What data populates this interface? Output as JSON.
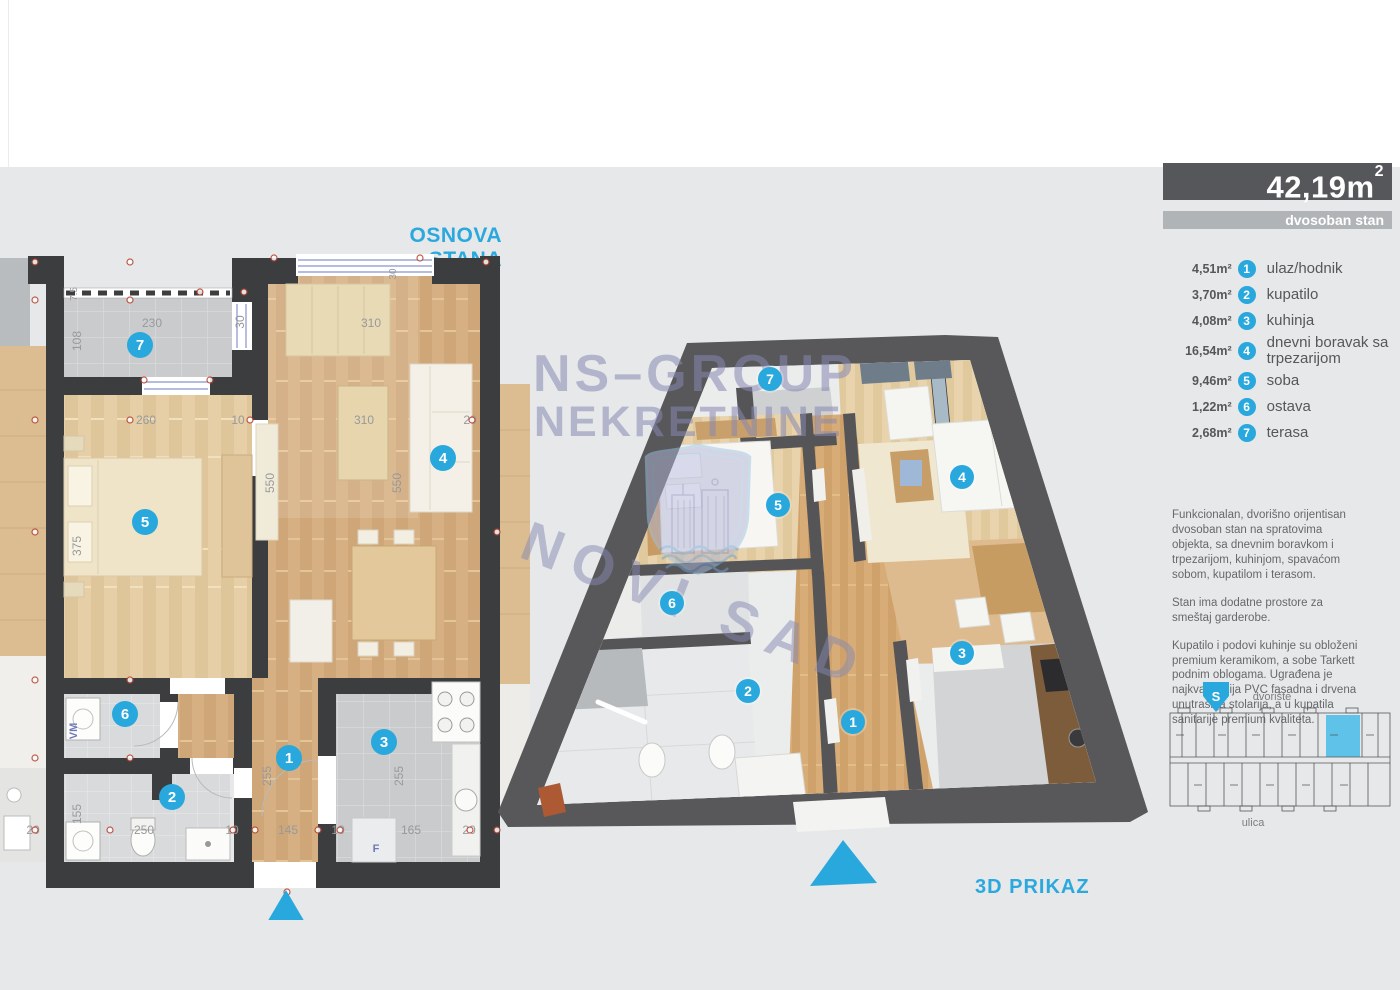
{
  "plan2d": {
    "title": "OSNOVA STANA",
    "dims": {
      "terrace_width": "230",
      "terrace_depth": "108",
      "rail": "7.5",
      "terrace_door": "30",
      "window_top": "30",
      "room5_width": "260",
      "room5_wall": "10",
      "room5_height": "375",
      "room4_width_a": "310",
      "room4_width_b": "310",
      "room4_height_a": "550",
      "room4_height_b": "550",
      "right_margin": "20",
      "left_margin_bottom": "20",
      "bath_height": "155",
      "bath_width": "250",
      "bath_wall": "10",
      "hall_width": "145",
      "hall_height": "255",
      "hall_wall": "10",
      "kitchen_width": "165",
      "kitchen_height": "255",
      "kitchen_margin": "20",
      "washer": "VM",
      "fridge": "F"
    }
  },
  "view3d": {
    "title": "3D PRIKAZ"
  },
  "watermark": {
    "line1": "NS–GROUP",
    "line2": "NEKRETNINE",
    "line3": "NOVI SAD"
  },
  "sidebar": {
    "area_value": "42,19m",
    "area_sup": "2",
    "unit_type": "dvosoban stan",
    "rooms": [
      {
        "area": "4,51m²",
        "number": "1",
        "label": "ulaz/hodnik"
      },
      {
        "area": "3,70m²",
        "number": "2",
        "label": "kupatilo"
      },
      {
        "area": "4,08m²",
        "number": "3",
        "label": "kuhinja"
      },
      {
        "area": "16,54m²",
        "number": "4",
        "label": "dnevni boravak sa trpezarijom"
      },
      {
        "area": "9,46m²",
        "number": "5",
        "label": "soba"
      },
      {
        "area": "1,22m²",
        "number": "6",
        "label": "ostava"
      },
      {
        "area": "2,68m²",
        "number": "7",
        "label": "terasa"
      }
    ],
    "description": [
      "Funkcionalan, dvorišno orijentisan dvosoban stan na spratovima objekta, sa dnevnim boravkom i trpezarijom, kuhinjom, spavaćom sobom, kupatilom i terasom.",
      "Stan ima dodatne prostore za smeštaj garderobe.",
      "Kupatilo i podovi kuhinje su obloženi premium keramikom, a sobe Tarkett podnim oblogama. Ugrađena je najkvalitetnija PVC fasadna i drvena unutrašnja stolarija, a u kupatila sanitarije premium kvaliteta."
    ],
    "position": {
      "top_label": "dvorište",
      "bottom_label": "ulica",
      "compass": "S"
    }
  },
  "colors": {
    "accent_cyan": "#29a8dd",
    "title_cyan": "#2ba9de",
    "dark_bar": "#55575a",
    "light_bar": "#b1b4b7",
    "wall_2d": "#3c3d3f",
    "wall_3d": "#58585a",
    "wood": "#d6b082",
    "tile_gray": "#c9cbcd",
    "red_marker": "#b8432f",
    "watermark_purple": "#8688b2",
    "highlight_unit": "#5fc3e9"
  }
}
